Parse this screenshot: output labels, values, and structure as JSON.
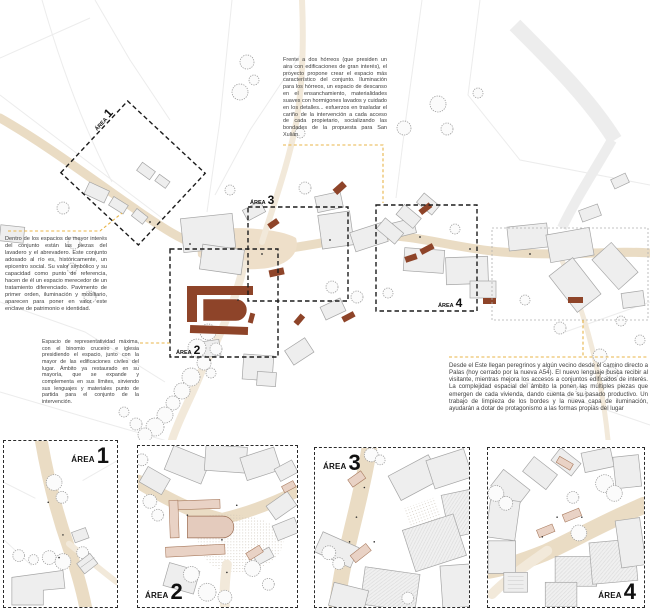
{
  "annotations": {
    "top_right": "Frente a dos hórreos (que presiden un aira con edificaciones de gran interés), el proyecto propone crear el espacio más característico del conjunto. Iluminación para los hórreos, un espacio de descanso en el ensanchamiento, materialidades suaves con hormigones lavados y cuidado en los detalles... esfuerzos en trasladar el cariño de la intervención a cada acceso de cada propietario, socializando las bondades de la propuesta para San Xulián.",
    "left_upper": "Dentro de los espacios de mayor interés del conjunto están las piezas del lavadero y el abrevadero. Este conjunto adosado al río es, históricamente, un epicentro social. Su valor simbólico y su capacidad como punto de referencia, hacen de él un espacio merecedor de un tratamiento diferenciado. Pavimento de primer orden, iluminación y mobiliario, aparecen para poner en valor este enclave de patrimonio e identidad.",
    "left_lower": "Espacio de representatividad máxima, con el binomio cruceiro e iglesia presidiendo el espacio, junto con la mayor de las edificaciones civiles del lugar. Ámbito ya restaurado en su mayoría, que se expande y complementa en sus límites, sirviendo sus lenguajes y materiales punto de partida para el conjunto de la intervención.",
    "right_lower": "Desde el Este llegan peregrinos y algún vecino desde el camino directo a Palas (hoy cerrado por la nueva A54). El nuevo lenguaje busca recibir al visitante, mientras mejora los accesos a conjuntos edificados de interés. La complejidad espacial del ámbito la ponen las múltiples piezas que emergen de cada vivienda, dando cuenta de su pasado productivo. Un trabajo de limpieza de los bordes y la nueva capa de iluminación, ayudarán a dotar de protagonismo a las formas propias del lugar"
  },
  "areas": [
    {
      "word": "ÁREA",
      "num": "1"
    },
    {
      "word": "ÁREA",
      "num": "2"
    },
    {
      "word": "ÁREA",
      "num": "3"
    },
    {
      "word": "ÁREA",
      "num": "4"
    }
  ],
  "colors": {
    "accent_brown": "#8e4429",
    "road_beige": "#eadcc4",
    "building_gray": "#eeeeee",
    "panel_pink": "#e9d2c5",
    "leader_yellow": "#e8b54a",
    "dash_black": "#1c1c1c"
  }
}
